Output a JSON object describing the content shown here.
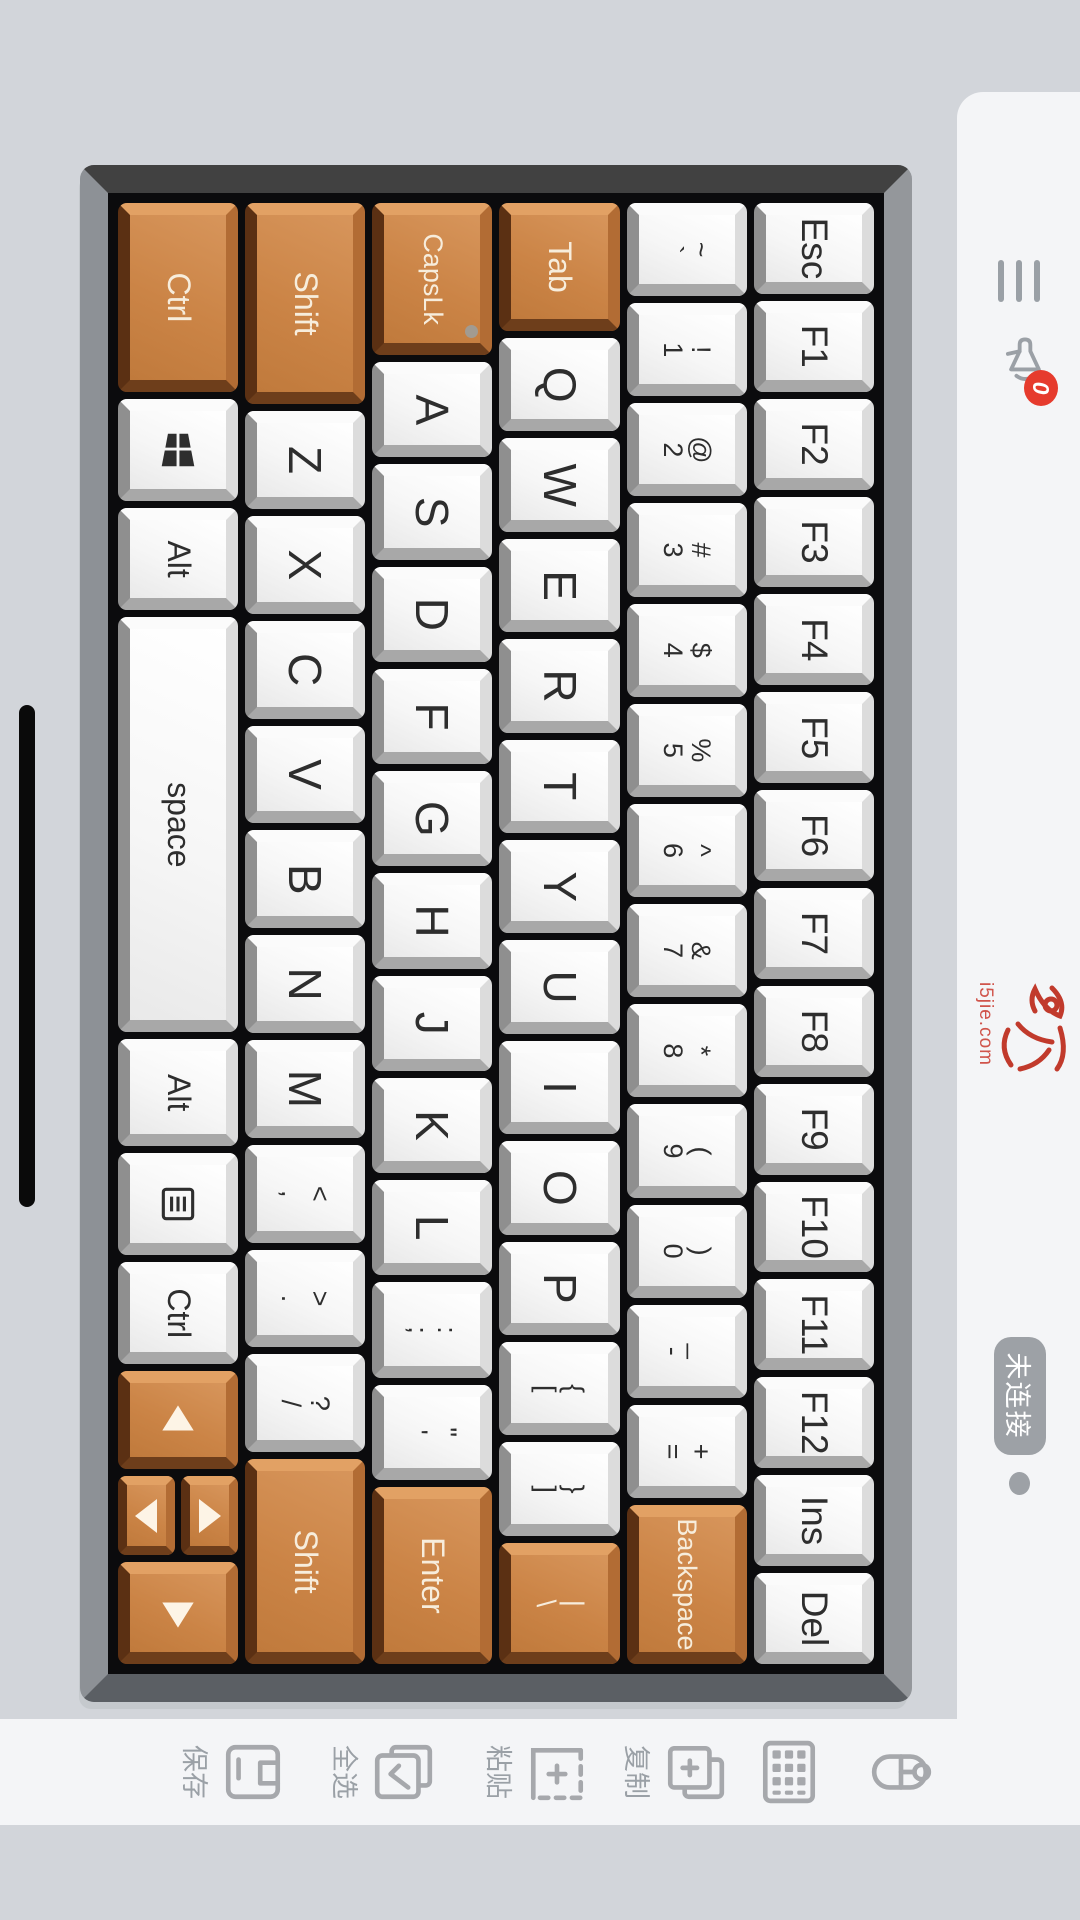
{
  "topbar": {
    "notification_count": "0",
    "logo_caption": "i5jie.com",
    "connection_status": "未连接"
  },
  "sidebar": {
    "items": [
      {
        "name": "mouse",
        "label": ""
      },
      {
        "name": "keypad",
        "label": ""
      },
      {
        "name": "copy",
        "label": "复制"
      },
      {
        "name": "paste",
        "label": "粘贴"
      },
      {
        "name": "select-all",
        "label": "全选"
      },
      {
        "name": "save",
        "label": "保存"
      }
    ]
  },
  "colors": {
    "orange_key": "#cb8446",
    "notification_badge": "#e63b2d",
    "logo_red": "#c13a2c",
    "connection_badge": "#9da1a6"
  },
  "keyboard": {
    "caps_indicator_led": true,
    "rows": [
      {
        "keys": [
          {
            "t": "Esc",
            "n": "esc",
            "cls": "fn"
          },
          {
            "t": "F1",
            "n": "f1",
            "cls": "fn"
          },
          {
            "t": "F2",
            "n": "f2",
            "cls": "fn"
          },
          {
            "t": "F3",
            "n": "f3",
            "cls": "fn"
          },
          {
            "t": "F4",
            "n": "f4",
            "cls": "fn"
          },
          {
            "t": "F5",
            "n": "f5",
            "cls": "fn"
          },
          {
            "t": "F6",
            "n": "f6",
            "cls": "fn"
          },
          {
            "t": "F7",
            "n": "f7",
            "cls": "fn"
          },
          {
            "t": "F8",
            "n": "f8",
            "cls": "fn"
          },
          {
            "t": "F9",
            "n": "f9",
            "cls": "fn"
          },
          {
            "t": "F10",
            "n": "f10",
            "cls": "fn"
          },
          {
            "t": "F11",
            "n": "f11",
            "cls": "fn"
          },
          {
            "t": "F12",
            "n": "f12",
            "cls": "fn"
          },
          {
            "t": "Ins",
            "n": "ins",
            "cls": "fn"
          },
          {
            "t": "Del",
            "n": "del",
            "cls": "fn"
          }
        ]
      },
      {
        "keys": [
          {
            "s": "~",
            "b": "`",
            "n": "grave"
          },
          {
            "s": "!",
            "b": "1",
            "n": "1"
          },
          {
            "s": "@",
            "b": "2",
            "n": "2"
          },
          {
            "s": "#",
            "b": "3",
            "n": "3"
          },
          {
            "s": "$",
            "b": "4",
            "n": "4"
          },
          {
            "s": "%",
            "b": "5",
            "n": "5"
          },
          {
            "s": "^",
            "b": "6",
            "n": "6"
          },
          {
            "s": "&",
            "b": "7",
            "n": "7"
          },
          {
            "s": "*",
            "b": "8",
            "n": "8"
          },
          {
            "s": "(",
            "b": "9",
            "n": "9"
          },
          {
            "s": ")",
            "b": "0",
            "n": "0"
          },
          {
            "s": "_",
            "b": "-",
            "n": "minus"
          },
          {
            "s": "+",
            "b": "=",
            "n": "equals"
          },
          {
            "t": "Backspace",
            "n": "backspace",
            "o": 1,
            "w": 1.95,
            "cls": "mod small"
          }
        ]
      },
      {
        "keys": [
          {
            "t": "Tab",
            "n": "tab",
            "o": 1,
            "w": 1.5,
            "cls": "mod"
          },
          {
            "t": "Q",
            "n": "q",
            "cls": "letter"
          },
          {
            "t": "W",
            "n": "w",
            "cls": "letter"
          },
          {
            "t": "E",
            "n": "e",
            "cls": "letter"
          },
          {
            "t": "R",
            "n": "r",
            "cls": "letter"
          },
          {
            "t": "T",
            "n": "t",
            "cls": "letter"
          },
          {
            "t": "Y",
            "n": "y",
            "cls": "letter"
          },
          {
            "t": "U",
            "n": "u",
            "cls": "letter"
          },
          {
            "t": "I",
            "n": "i",
            "cls": "letter"
          },
          {
            "t": "O",
            "n": "o",
            "cls": "letter"
          },
          {
            "t": "P",
            "n": "p",
            "cls": "letter"
          },
          {
            "s": "{",
            "b": "[",
            "n": "bracket-open"
          },
          {
            "s": "}",
            "b": "]",
            "n": "bracket-close"
          },
          {
            "s": "|",
            "b": "\\",
            "n": "backslash",
            "o": 1,
            "w": 1.4
          }
        ]
      },
      {
        "keys": [
          {
            "t": "CapsLk",
            "n": "capslock",
            "o": 1,
            "w": 1.8,
            "cls": "mod small",
            "led": 1
          },
          {
            "t": "A",
            "n": "a",
            "cls": "letter"
          },
          {
            "t": "S",
            "n": "s",
            "cls": "letter"
          },
          {
            "t": "D",
            "n": "d",
            "cls": "letter"
          },
          {
            "t": "F",
            "n": "f",
            "cls": "letter"
          },
          {
            "t": "G",
            "n": "g",
            "cls": "letter"
          },
          {
            "t": "H",
            "n": "h",
            "cls": "letter"
          },
          {
            "t": "J",
            "n": "j",
            "cls": "letter"
          },
          {
            "t": "K",
            "n": "k",
            "cls": "letter"
          },
          {
            "t": "L",
            "n": "l",
            "cls": "letter"
          },
          {
            "s": ":",
            "b": ";",
            "n": "semicolon"
          },
          {
            "s": "\"",
            "b": "'",
            "n": "quote"
          },
          {
            "t": "Enter",
            "n": "enter",
            "o": 1,
            "w": 2.15,
            "cls": "mod"
          }
        ]
      },
      {
        "keys": [
          {
            "t": "Shift",
            "n": "shift-left",
            "o": 1,
            "w": 2.4,
            "cls": "mod"
          },
          {
            "t": "Z",
            "n": "z",
            "cls": "letter"
          },
          {
            "t": "X",
            "n": "x",
            "cls": "letter"
          },
          {
            "t": "C",
            "n": "c",
            "cls": "letter"
          },
          {
            "t": "V",
            "n": "v",
            "cls": "letter"
          },
          {
            "t": "B",
            "n": "b",
            "cls": "letter"
          },
          {
            "t": "N",
            "n": "n",
            "cls": "letter"
          },
          {
            "t": "M",
            "n": "m",
            "cls": "letter"
          },
          {
            "s": "<",
            "b": ",",
            "n": "comma"
          },
          {
            "s": ">",
            "b": ".",
            "n": "period"
          },
          {
            "s": "?",
            "b": "/",
            "n": "slash"
          },
          {
            "t": "Shift",
            "n": "shift-right",
            "o": 1,
            "w": 2.45,
            "cls": "mod"
          }
        ]
      },
      {
        "keys": [
          {
            "t": "Ctrl",
            "n": "ctrl-left",
            "o": 1,
            "w": 2,
            "cls": "mod"
          },
          {
            "icon": "win-logo-icon",
            "n": "win",
            "w": 0.95
          },
          {
            "t": "Alt",
            "n": "alt-left",
            "cls": "mod",
            "w": 0.95
          },
          {
            "t": "space",
            "n": "space",
            "cls": "mod",
            "w": 4.75
          },
          {
            "t": "Alt",
            "n": "alt-right",
            "cls": "mod",
            "w": 1
          },
          {
            "icon": "menu-icon",
            "n": "menu",
            "w": 0.95
          },
          {
            "t": "Ctrl",
            "n": "ctrl-right",
            "cls": "mod",
            "w": 0.95
          },
          {
            "icon": "arrow-left-icon",
            "n": "arrow-left",
            "o": 1,
            "w": 0.9
          },
          {
            "stack": [
              {
                "icon": "arrow-up-icon",
                "n": "arrow-up"
              },
              {
                "icon": "arrow-down-icon",
                "n": "arrow-down"
              }
            ],
            "o": 1,
            "w": 0.95
          },
          {
            "icon": "arrow-right-icon",
            "n": "arrow-right",
            "o": 1,
            "w": 0.95
          }
        ]
      }
    ]
  }
}
